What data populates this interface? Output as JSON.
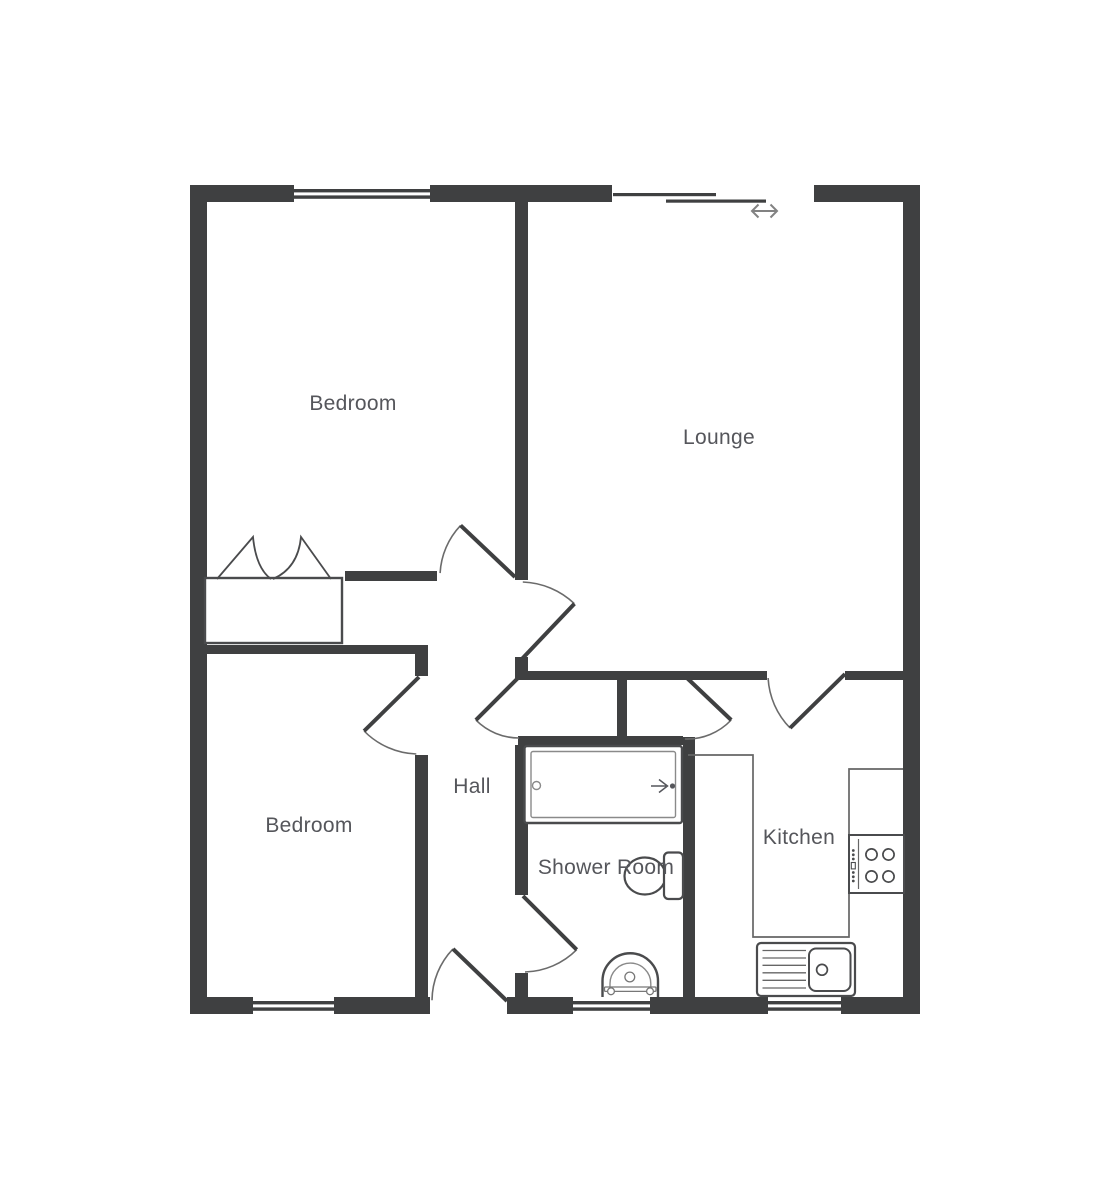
{
  "colors": {
    "wall": "#3f4041",
    "arc": "#6b6b6b",
    "fixture": "#4a4b4d",
    "thin": "#8a8a8a",
    "counter": "#666666",
    "label": "#55565b",
    "slider_arrow": "#828282",
    "background": "#ffffff"
  },
  "rooms": {
    "bedroom1": {
      "label": "Bedroom",
      "x": 353,
      "y": 404
    },
    "lounge": {
      "label": "Lounge",
      "x": 719,
      "y": 438
    },
    "bedroom2": {
      "label": "Bedroom",
      "x": 309,
      "y": 826
    },
    "hall": {
      "label": "Hall",
      "x": 472,
      "y": 787
    },
    "shower": {
      "label": "Shower Room",
      "x": 606,
      "y": 868
    },
    "kitchen": {
      "label": "Kitchen",
      "x": 799,
      "y": 838
    }
  },
  "walls": [
    [
      190,
      185,
      104,
      17
    ],
    [
      430,
      185,
      182,
      17
    ],
    [
      814,
      185,
      106,
      17
    ],
    [
      190,
      185,
      17,
      829
    ],
    [
      903,
      185,
      17,
      829
    ],
    [
      190,
      997,
      63,
      17
    ],
    [
      334,
      997,
      96,
      17
    ],
    [
      507,
      997,
      66,
      17
    ],
    [
      650,
      997,
      118,
      17
    ],
    [
      841,
      997,
      79,
      17
    ],
    [
      515,
      202,
      13,
      378
    ],
    [
      345,
      571,
      92,
      10
    ],
    [
      207,
      645,
      214,
      9
    ],
    [
      415,
      645,
      13,
      31
    ],
    [
      415,
      755,
      13,
      242
    ],
    [
      515,
      657,
      13,
      23
    ],
    [
      518,
      671,
      249,
      9
    ],
    [
      845,
      671,
      58,
      9
    ],
    [
      617,
      680,
      10,
      56
    ],
    [
      518,
      736,
      165,
      9
    ],
    [
      515,
      745,
      13,
      150
    ],
    [
      515,
      973,
      13,
      24
    ],
    [
      683,
      737,
      12,
      260
    ]
  ],
  "windows": [
    {
      "x": 294,
      "y": 185,
      "w": 136,
      "h": 17
    },
    {
      "x": 253,
      "y": 997,
      "w": 81,
      "h": 17
    },
    {
      "x": 573,
      "y": 997,
      "w": 77,
      "h": 17
    },
    {
      "x": 768,
      "y": 997,
      "w": 73,
      "h": 17
    }
  ],
  "slider": {
    "panels": [
      [
        613,
        193,
        103,
        3.2
      ],
      [
        666,
        199.5,
        100,
        3.2
      ]
    ],
    "arrow": {
      "x1": 752,
      "x2": 777,
      "y": 211,
      "head": 6.5
    }
  },
  "doors": [
    {
      "name": "bedroom1-door",
      "h": [
        515,
        577
      ],
      "r": 75,
      "leaf": 223.5,
      "a1": 183,
      "a2": 223.5
    },
    {
      "name": "lounge-door",
      "h": [
        520,
        661
      ],
      "r": 79,
      "leaf": 313.5,
      "a1": 272,
      "a2": 313.5
    },
    {
      "name": "hall-cupboard-door",
      "h": [
        519,
        677
      ],
      "r": 61,
      "leaf": 135,
      "a1": 90,
      "a2": 135
    },
    {
      "name": "kitchen-nook-door",
      "h": [
        687,
        678
      ],
      "r": 61,
      "leaf": 43.5,
      "a1": 43.5,
      "a2": 92
    },
    {
      "name": "kitchen-door",
      "h": [
        845,
        674
      ],
      "r": 77,
      "leaf": 135.5,
      "a1": 135.5,
      "a2": 177
    },
    {
      "name": "bedroom2-door",
      "h": [
        419,
        677
      ],
      "r": 77,
      "leaf": 135.5,
      "a1": 92,
      "a2": 135.5
    },
    {
      "name": "front-door",
      "h": [
        507,
        1001
      ],
      "r": 75,
      "leaf": 224,
      "a1": 180.5,
      "a2": 224
    },
    {
      "name": "shower-door",
      "h": [
        523,
        896
      ],
      "r": 76,
      "leaf": 45,
      "a1": 45,
      "a2": 88.5
    }
  ],
  "fixtures": [
    {
      "t": "path",
      "n": "kitchen-counter",
      "d": "M688,755 H753 V937 H849 V769 H903",
      "s": "#666666",
      "w": 1.7,
      "f": "none"
    },
    {
      "t": "rect",
      "n": "wardrobe-box",
      "x": 205,
      "y": 578,
      "wd": 137,
      "ht": 65,
      "rx": 0,
      "s": "#4a4b4d",
      "w": 2.4,
      "f": "#ffffff"
    },
    {
      "t": "path",
      "n": "wardrobe-door-left",
      "d": "M217,579 L253,537 Q256,568 271,579",
      "s": "#4a4b4d",
      "w": 1.8,
      "f": "none"
    },
    {
      "t": "path",
      "n": "wardrobe-door-right",
      "d": "M331,579 L301,537 Q298,568 273,579",
      "s": "#4a4b4d",
      "w": 1.8,
      "f": "none"
    },
    {
      "t": "rect",
      "n": "bathtub-outer",
      "x": 524.5,
      "y": 746,
      "wd": 157.5,
      "ht": 77,
      "rx": 2.5,
      "s": "#4a4b4d",
      "w": 2.4,
      "f": "#ffffff"
    },
    {
      "t": "rect",
      "n": "bathtub-inner",
      "x": 531,
      "y": 751.5,
      "wd": 144.5,
      "ht": 66,
      "rx": 2,
      "s": "#8a8a8a",
      "w": 1.4,
      "f": "none"
    },
    {
      "t": "circle",
      "n": "bathtub-tap",
      "cx": 536.5,
      "cy": 785.5,
      "r": 4,
      "s": "#8a8a8a",
      "w": 1.4,
      "f": "none"
    },
    {
      "t": "path",
      "n": "bathtub-shower-arrow",
      "d": "M651,786 H666 M659,779.5 L667.5,786 L659,792.5",
      "s": "#55565b",
      "w": 1.5,
      "f": "none"
    },
    {
      "t": "circle",
      "n": "bathtub-arrow-dot",
      "cx": 672.5,
      "cy": 786,
      "r": 2.6,
      "s": "none",
      "w": 0,
      "f": "#55565b"
    },
    {
      "t": "ellipse",
      "n": "toilet-bowl",
      "cx": 645,
      "cy": 876,
      "rx2": 20.5,
      "ry2": 18.5,
      "s": "#4a4b4d",
      "w": 2.2,
      "f": "#ffffff"
    },
    {
      "t": "rect",
      "n": "toilet-cistern",
      "x": 664,
      "y": 852.5,
      "wd": 19,
      "ht": 46.5,
      "rx": 4.5,
      "s": "#4a4b4d",
      "w": 2.2,
      "f": "#ffffff"
    },
    {
      "t": "path",
      "n": "basin-outer",
      "d": "M602.5,997 V981 A27.7,27.7 0 0 1 658,981 V997",
      "s": "#4a4b4d",
      "w": 2.4,
      "f": "#ffffff"
    },
    {
      "t": "path",
      "n": "basin-inner",
      "d": "M610,995 V983.5 A20.4,20.4 0 0 1 650.8,983.5 V995",
      "s": "#8a8a8a",
      "w": 1.4,
      "f": "none"
    },
    {
      "t": "rect",
      "n": "basin-bar",
      "x": 604.5,
      "y": 987,
      "wd": 51.5,
      "ht": 4.4,
      "rx": 1,
      "s": "#777777",
      "w": 1.3,
      "f": "#ffffff"
    },
    {
      "t": "circle",
      "n": "basin-knob-left",
      "cx": 611,
      "cy": 991.3,
      "r": 3.4,
      "s": "#777777",
      "w": 1.3,
      "f": "#ffffff"
    },
    {
      "t": "circle",
      "n": "basin-knob-right",
      "cx": 650,
      "cy": 991.3,
      "r": 3.4,
      "s": "#777777",
      "w": 1.3,
      "f": "#ffffff"
    },
    {
      "t": "circle",
      "n": "basin-drain",
      "cx": 629.8,
      "cy": 977,
      "r": 4.9,
      "s": "#777777",
      "w": 1.3,
      "f": "#ffffff"
    },
    {
      "t": "rect",
      "n": "hob",
      "x": 849,
      "y": 835,
      "wd": 55,
      "ht": 58,
      "rx": 0,
      "s": "#4a4b4d",
      "w": 2,
      "f": "#ffffff"
    },
    {
      "t": "line",
      "n": "hob-divider",
      "x1": 858.5,
      "y1": 839,
      "x2": 858.5,
      "y2": 889,
      "s": "#666666",
      "w": 1.2
    },
    {
      "t": "circle",
      "n": "hob-burner-1",
      "cx": 871.5,
      "cy": 854.5,
      "r": 5.6,
      "s": "#4a4b4d",
      "w": 1.7,
      "f": "none"
    },
    {
      "t": "circle",
      "n": "hob-burner-2",
      "cx": 888.5,
      "cy": 854.5,
      "r": 5.6,
      "s": "#4a4b4d",
      "w": 1.7,
      "f": "none"
    },
    {
      "t": "circle",
      "n": "hob-burner-3",
      "cx": 871.5,
      "cy": 876.5,
      "r": 5.6,
      "s": "#4a4b4d",
      "w": 1.7,
      "f": "none"
    },
    {
      "t": "circle",
      "n": "hob-burner-4",
      "cx": 888.5,
      "cy": 876.5,
      "r": 5.6,
      "s": "#4a4b4d",
      "w": 1.7,
      "f": "none"
    },
    {
      "t": "circle",
      "n": "hob-knob-dot",
      "cx": 853.3,
      "cy": 850.5,
      "r": 1.4,
      "s": "none",
      "w": 0,
      "f": "#4a4b4d"
    },
    {
      "t": "circle",
      "n": "hob-knob-dot",
      "cx": 853.3,
      "cy": 854.8,
      "r": 1.4,
      "s": "none",
      "w": 0,
      "f": "#4a4b4d"
    },
    {
      "t": "circle",
      "n": "hob-knob-dot",
      "cx": 853.3,
      "cy": 859,
      "r": 1.4,
      "s": "none",
      "w": 0,
      "f": "#4a4b4d"
    },
    {
      "t": "rect",
      "n": "hob-switch",
      "x": 851.3,
      "y": 862.5,
      "wd": 4,
      "ht": 6.4,
      "rx": 0,
      "s": "#4a4b4d",
      "w": 1.1,
      "f": "#ffffff"
    },
    {
      "t": "circle",
      "n": "hob-knob-dot",
      "cx": 853.3,
      "cy": 872.5,
      "r": 1.4,
      "s": "none",
      "w": 0,
      "f": "#4a4b4d"
    },
    {
      "t": "circle",
      "n": "hob-knob-dot",
      "cx": 853.3,
      "cy": 876.8,
      "r": 1.4,
      "s": "none",
      "w": 0,
      "f": "#4a4b4d"
    },
    {
      "t": "circle",
      "n": "hob-knob-dot",
      "cx": 853.3,
      "cy": 881,
      "r": 1.4,
      "s": "none",
      "w": 0,
      "f": "#4a4b4d"
    },
    {
      "t": "rect",
      "n": "sink-unit",
      "x": 757,
      "y": 943,
      "wd": 98,
      "ht": 53,
      "rx": 4,
      "s": "#4a4b4d",
      "w": 2.2,
      "f": "#ffffff"
    },
    {
      "t": "line",
      "n": "sink-drainer-line",
      "x1": 762.5,
      "y1": 950.5,
      "x2": 806,
      "y2": 950.5,
      "s": "#666666",
      "w": 1.3
    },
    {
      "t": "line",
      "n": "sink-drainer-line",
      "x1": 762.5,
      "y1": 958,
      "x2": 806,
      "y2": 958,
      "s": "#666666",
      "w": 1.3
    },
    {
      "t": "line",
      "n": "sink-drainer-line",
      "x1": 762.5,
      "y1": 965.3,
      "x2": 806,
      "y2": 965.3,
      "s": "#666666",
      "w": 1.3
    },
    {
      "t": "line",
      "n": "sink-drainer-line",
      "x1": 762.5,
      "y1": 972.8,
      "x2": 806,
      "y2": 972.8,
      "s": "#666666",
      "w": 1.3
    },
    {
      "t": "line",
      "n": "sink-drainer-line",
      "x1": 762.5,
      "y1": 980.3,
      "x2": 806,
      "y2": 980.3,
      "s": "#666666",
      "w": 1.3
    },
    {
      "t": "line",
      "n": "sink-drainer-line",
      "x1": 762.5,
      "y1": 988,
      "x2": 806,
      "y2": 988,
      "s": "#666666",
      "w": 1.3
    },
    {
      "t": "rect",
      "n": "sink-bowl",
      "x": 809,
      "y": 948.5,
      "wd": 41.5,
      "ht": 42.5,
      "rx": 7,
      "s": "#4a4b4d",
      "w": 2,
      "f": "#ffffff"
    },
    {
      "t": "circle",
      "n": "sink-drain",
      "cx": 822,
      "cy": 969.8,
      "r": 5.4,
      "s": "#4a4b4d",
      "w": 1.7,
      "f": "none"
    }
  ]
}
